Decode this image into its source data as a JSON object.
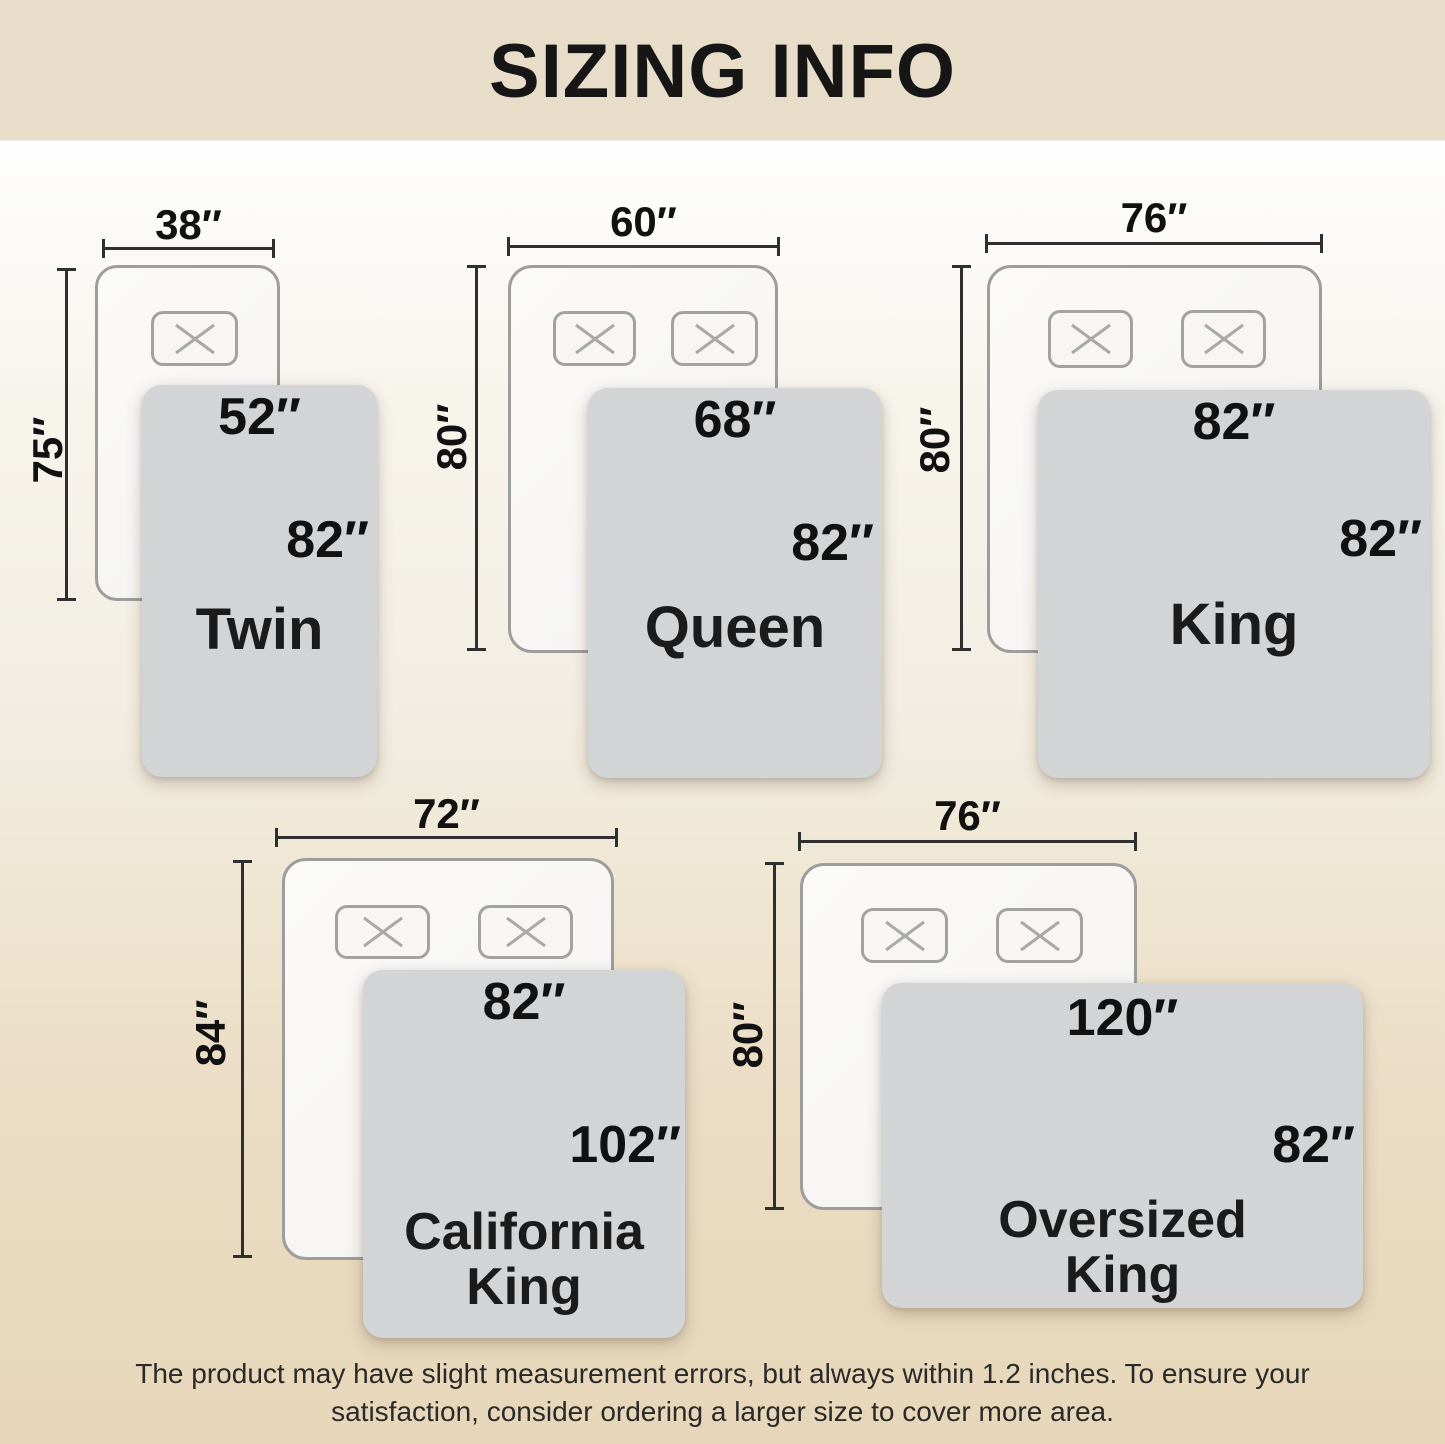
{
  "title": "SIZING INFO",
  "footer": {
    "line1": "The product may have slight measurement errors, but always within 1.2 inches. To ensure your",
    "line2": "satisfaction, consider ordering a larger size to cover more area."
  },
  "colors": {
    "banner_bg": "#e8ddc8",
    "page_bottom": "#e7d6b9",
    "blanket_fill": "#d3d4d5",
    "bed_fill": "#f6f5f3",
    "bed_border": "#9d9d9b",
    "dimension_line": "#2f2f2f",
    "label_text": "#111111"
  },
  "diagrams": [
    {
      "name_line1": "Twin",
      "name_line2": "",
      "bed_width": "38″",
      "bed_height": "75″",
      "blanket_width": "52″",
      "blanket_height": "82″",
      "pillows": 1
    },
    {
      "name_line1": "Queen",
      "name_line2": "",
      "bed_width": "60″",
      "bed_height": "80″",
      "blanket_width": "68″",
      "blanket_height": "82″",
      "pillows": 2
    },
    {
      "name_line1": "King",
      "name_line2": "",
      "bed_width": "76″",
      "bed_height": "80″",
      "blanket_width": "82″",
      "blanket_height": "82″",
      "pillows": 2
    },
    {
      "name_line1": "California",
      "name_line2": "King",
      "bed_width": "72″",
      "bed_height": "84″",
      "blanket_width": "82″",
      "blanket_height": "102″",
      "pillows": 2
    },
    {
      "name_line1": "Oversized",
      "name_line2": "King",
      "bed_width": "76″",
      "bed_height": "80″",
      "blanket_width": "120″",
      "blanket_height": "82″",
      "pillows": 2
    }
  ]
}
